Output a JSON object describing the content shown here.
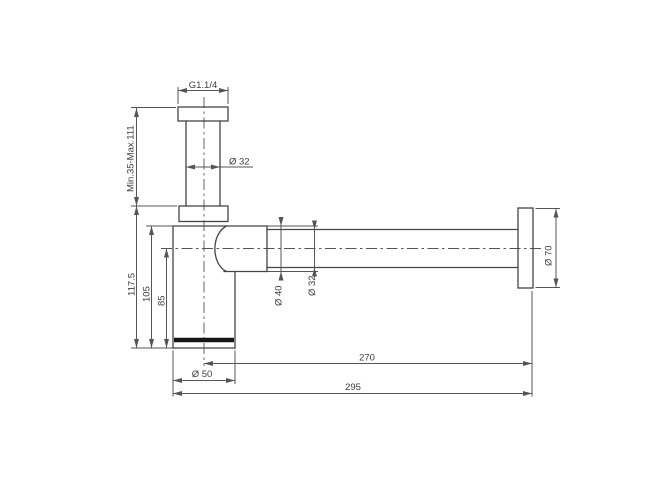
{
  "drawing": {
    "labels": {
      "thread": "G1.1/4",
      "inlet_range": "Min.35-Max.111",
      "inlet_dia": "Ø 32",
      "height_total": "117.5",
      "height_body": "105",
      "height_axis": "85",
      "outlet_nut_dia": "Ø 40",
      "tube_dia": "Ø 32",
      "rosette_dia": "Ø 70",
      "axis_to_wall": "270",
      "body_dia": "Ø 50",
      "total_length": "295"
    },
    "colors": {
      "line": "#454545",
      "dimension": "#555555",
      "text": "#3c3c3c",
      "thick_accent": "#161616",
      "background": "#ffffff"
    }
  }
}
